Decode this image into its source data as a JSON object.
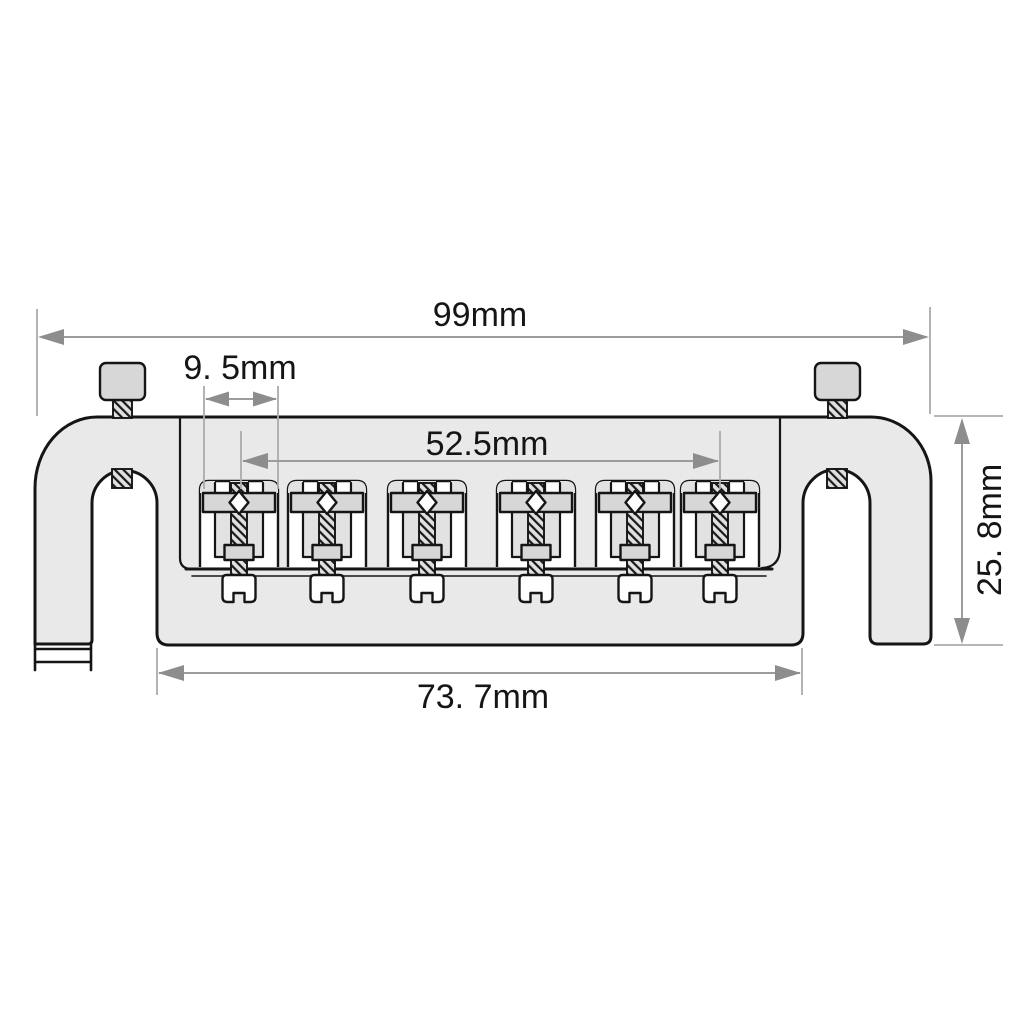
{
  "diagram": {
    "subject": "Guitar bridge technical drawing, front view with dimension callouts",
    "dimension_labels": {
      "overall_width": "99mm",
      "saddle_pitch": "9. 5mm",
      "saddle_span": "52.5mm",
      "body_height": "25. 8mm",
      "mounting_width": "73. 7mm"
    },
    "parts": {
      "body": "bridge base plate with two U-notch legs",
      "posts": [
        "left thumbscrew post",
        "right thumbscrew post"
      ],
      "saddle_count": 6,
      "saddle": "string saddle with intonation screw, nut and slotted screw head"
    },
    "colors": {
      "background": "#ffffff",
      "body_fill": "#e9e9e9",
      "hardware_fill": "#d7d7d7",
      "outline": "#151515",
      "dimension_line": "#9c9c9c",
      "extension_line": "#ababab",
      "arrow": "#8d8d8d",
      "label_text": "#151515"
    }
  }
}
